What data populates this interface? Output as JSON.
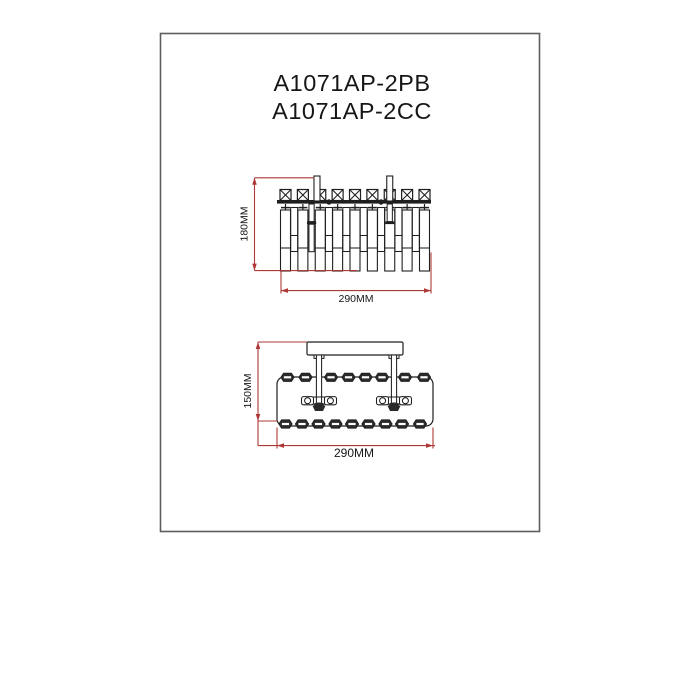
{
  "page": {
    "background": "#ffffff",
    "border_color": "#5e5e5e"
  },
  "colors": {
    "line": "#1f1f1f",
    "dimension": "#ae3836",
    "dark_fill": "#2a2a2a",
    "text": "#161616"
  },
  "title": {
    "line1": "A1071AP-2PB",
    "line2": "A1071AP-2CC"
  },
  "front_view": {
    "view": "front elevation of crystal wall lamp",
    "height_label": "180MM",
    "width_label": "290MM",
    "mount_box_count": 9,
    "front_crystal_count": 9,
    "back_crystal_slots": [
      0,
      2,
      3,
      4,
      5,
      6,
      7
    ],
    "stem_count": 2,
    "knob_count": 2
  },
  "top_view": {
    "view": "top plan of crystal wall lamp",
    "height_label": "150MM",
    "width_label": "290MM",
    "top_bead_centers": [
      287.5,
      305.5,
      331,
      348.5,
      365.5,
      382,
      405,
      424
    ],
    "bottom_bead_centers": [
      285.5,
      302,
      318.5,
      335.5,
      352,
      368.5,
      385.5,
      402,
      420
    ],
    "socket_centers": [
      319,
      394
    ]
  }
}
